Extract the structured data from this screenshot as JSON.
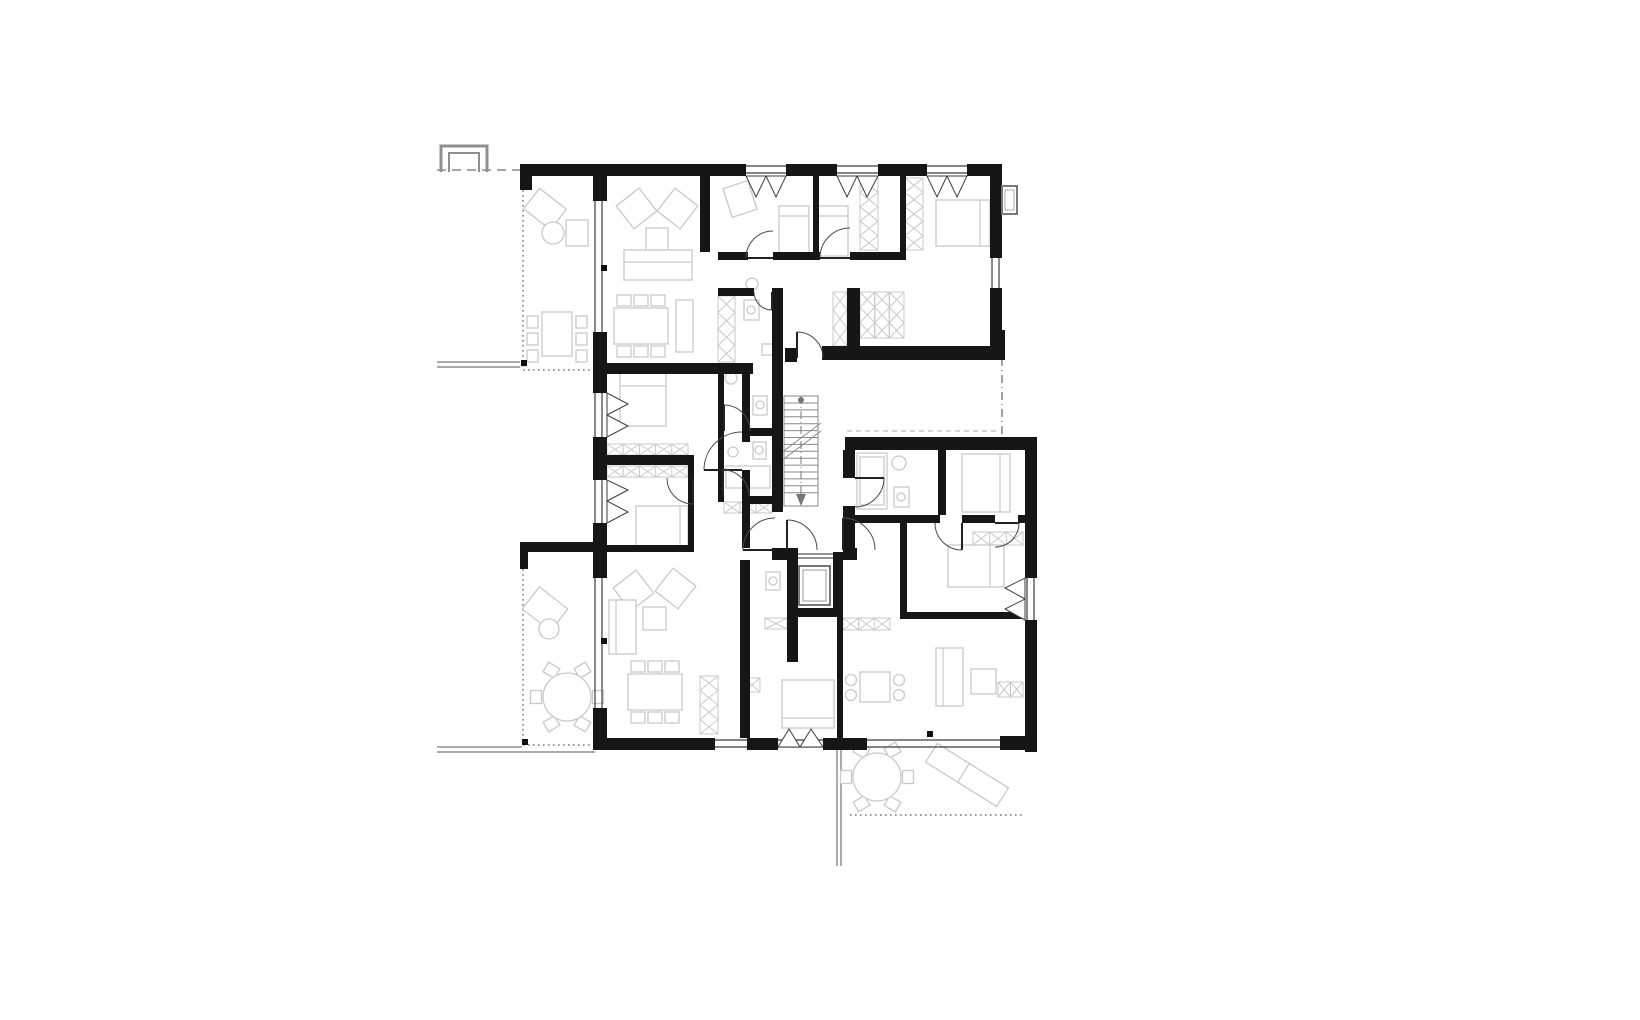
{
  "canvas": {
    "w": 1640,
    "h": 1020,
    "bg": "#ffffff"
  },
  "palette": {
    "wall": "#161616",
    "line": "#3c3c3c",
    "door": "#4a4a4a",
    "light": "#c9c9c9",
    "mid": "#8f8f8f",
    "stair": "#8a8a8a",
    "dot": "#111111",
    "bg": "#ffffff"
  },
  "plan": {
    "thin_lines": [
      [
        437,
        362,
        520,
        362
      ],
      [
        437,
        367,
        520,
        367
      ],
      [
        437,
        747,
        522,
        747
      ],
      [
        437,
        752,
        595,
        752
      ],
      [
        837,
        750,
        837,
        866
      ],
      [
        841,
        750,
        841,
        866
      ]
    ],
    "dashed_lines": [
      {
        "p": [
          437,
          170,
          520,
          170
        ],
        "d": "9 6",
        "c": "#8a8a8a"
      },
      {
        "p": [
          1002,
          358,
          1002,
          437
        ],
        "d": "8 4 1 4",
        "c": "#8a8a8a"
      },
      {
        "p": [
          847,
          431,
          1000,
          431
        ],
        "d": "5 4",
        "c": "#c9c9c9"
      }
    ],
    "dotted_edges": [
      [
        523,
        190,
        523,
        370
      ],
      [
        523,
        370,
        593,
        370
      ],
      [
        523,
        569,
        523,
        745
      ],
      [
        523,
        745,
        593,
        745
      ],
      [
        850,
        815,
        1025,
        815
      ]
    ],
    "chimney": [
      [
        [
          441,
          172
        ],
        [
          441,
          146
        ],
        [
          487,
          146
        ],
        [
          487,
          172
        ]
      ],
      [
        [
          449,
          172
        ],
        [
          449,
          153
        ],
        [
          479,
          153
        ],
        [
          479,
          172
        ]
      ]
    ],
    "walls": [
      [
        520,
        164,
        226,
        12
      ],
      [
        786,
        164,
        51,
        12
      ],
      [
        878,
        164,
        49,
        12
      ],
      [
        967,
        164,
        35,
        12
      ],
      [
        990,
        164,
        12,
        94
      ],
      [
        990,
        288,
        12,
        58
      ],
      [
        993,
        330,
        12,
        16
      ],
      [
        822,
        346,
        183,
        14
      ],
      [
        785,
        348,
        12,
        14
      ],
      [
        520,
        164,
        12,
        26
      ],
      [
        593,
        176,
        14,
        25
      ],
      [
        593,
        332,
        14,
        31
      ],
      [
        593,
        363,
        160,
        11
      ],
      [
        700,
        176,
        10,
        76
      ],
      [
        718,
        252,
        30,
        8
      ],
      [
        773,
        252,
        47,
        8
      ],
      [
        850,
        252,
        55,
        8
      ],
      [
        813,
        176,
        6,
        84
      ],
      [
        900,
        176,
        6,
        84
      ],
      [
        718,
        288,
        36,
        8
      ],
      [
        772,
        288,
        11,
        224
      ],
      [
        847,
        288,
        13,
        72
      ],
      [
        742,
        368,
        8,
        74
      ],
      [
        742,
        470,
        8,
        78
      ],
      [
        593,
        374,
        14,
        19
      ],
      [
        593,
        437,
        14,
        43
      ],
      [
        593,
        523,
        14,
        55
      ],
      [
        593,
        708,
        14,
        42
      ],
      [
        520,
        542,
        87,
        10
      ],
      [
        520,
        542,
        8,
        27
      ],
      [
        607,
        455,
        86,
        10
      ],
      [
        688,
        455,
        6,
        95
      ],
      [
        607,
        545,
        87,
        7
      ],
      [
        718,
        368,
        6,
        134
      ],
      [
        750,
        428,
        22,
        8
      ],
      [
        749,
        496,
        23,
        8
      ],
      [
        740,
        560,
        10,
        178
      ],
      [
        772,
        548,
        16,
        12
      ],
      [
        843,
        548,
        14,
        12
      ],
      [
        787,
        548,
        11,
        69
      ],
      [
        833,
        552,
        10,
        64
      ],
      [
        787,
        608,
        56,
        9
      ],
      [
        787,
        617,
        11,
        45
      ],
      [
        837,
        617,
        6,
        121
      ],
      [
        600,
        738,
        115,
        12
      ],
      [
        747,
        738,
        31,
        12
      ],
      [
        823,
        738,
        44,
        12
      ],
      [
        1000,
        736,
        37,
        14
      ],
      [
        845,
        437,
        192,
        13
      ],
      [
        1025,
        450,
        12,
        128
      ],
      [
        1025,
        620,
        12,
        132
      ],
      [
        843,
        450,
        12,
        28
      ],
      [
        843,
        506,
        12,
        42
      ],
      [
        855,
        515,
        85,
        8
      ],
      [
        962,
        515,
        33,
        8
      ],
      [
        1018,
        515,
        7,
        8
      ],
      [
        938,
        450,
        8,
        65
      ],
      [
        900,
        523,
        7,
        90
      ],
      [
        900,
        612,
        125,
        7
      ]
    ],
    "glazings": [
      {
        "o": "h",
        "x": 746,
        "y": 166,
        "l": 40
      },
      {
        "o": "h",
        "x": 837,
        "y": 166,
        "l": 41
      },
      {
        "o": "h",
        "x": 927,
        "y": 166,
        "l": 40
      },
      {
        "o": "v",
        "x": 992,
        "y": 258,
        "l": 30
      },
      {
        "o": "v",
        "x": 595,
        "y": 201,
        "l": 131
      },
      {
        "o": "v",
        "x": 595,
        "y": 393,
        "l": 44
      },
      {
        "o": "v",
        "x": 595,
        "y": 480,
        "l": 43
      },
      {
        "o": "v",
        "x": 595,
        "y": 578,
        "l": 130
      },
      {
        "o": "h",
        "x": 715,
        "y": 740,
        "l": 32
      },
      {
        "o": "h",
        "x": 778,
        "y": 740,
        "l": 45
      },
      {
        "o": "h",
        "x": 867,
        "y": 740,
        "l": 133
      },
      {
        "o": "v",
        "x": 1027,
        "y": 578,
        "l": 42
      }
    ],
    "triangles": [
      [
        746,
        176,
        766,
        176,
        756,
        197
      ],
      [
        766,
        176,
        786,
        176,
        776,
        197
      ],
      [
        837,
        176,
        857,
        176,
        847,
        197
      ],
      [
        857,
        176,
        878,
        176,
        867,
        197
      ],
      [
        927,
        176,
        947,
        176,
        937,
        197
      ],
      [
        947,
        176,
        967,
        176,
        957,
        197
      ],
      [
        607,
        393,
        607,
        415,
        628,
        404
      ],
      [
        607,
        415,
        607,
        437,
        628,
        426
      ],
      [
        607,
        480,
        607,
        501,
        628,
        490
      ],
      [
        607,
        501,
        607,
        523,
        628,
        512
      ],
      [
        778,
        747,
        800,
        747,
        789,
        729
      ],
      [
        800,
        747,
        823,
        747,
        811,
        729
      ],
      [
        1025,
        578,
        1025,
        599,
        1005,
        588
      ],
      [
        1025,
        599,
        1025,
        620,
        1005,
        609
      ]
    ],
    "xstrips": [
      [
        718,
        296,
        17,
        66
      ],
      [
        860,
        178,
        18,
        72
      ],
      [
        905,
        178,
        18,
        72
      ],
      [
        860,
        292,
        44,
        46
      ],
      [
        833,
        292,
        14,
        54
      ],
      [
        607,
        444,
        81,
        11
      ],
      [
        607,
        466,
        81,
        11
      ],
      [
        724,
        502,
        48,
        11
      ],
      [
        765,
        618,
        22,
        11
      ],
      [
        843,
        618,
        47,
        12
      ],
      [
        973,
        532,
        50,
        13
      ],
      [
        700,
        676,
        18,
        58
      ],
      [
        744,
        678,
        16,
        14
      ],
      [
        998,
        682,
        25,
        15
      ]
    ],
    "furn_rects": [
      [
        528,
        196,
        34,
        26,
        38
      ],
      [
        566,
        220,
        22,
        26,
        0
      ],
      [
        542,
        312,
        30,
        44,
        0
      ],
      [
        527,
        316,
        11,
        12,
        0
      ],
      [
        527,
        333,
        11,
        12,
        0
      ],
      [
        527,
        350,
        11,
        12,
        0
      ],
      [
        576,
        316,
        11,
        12,
        0
      ],
      [
        576,
        333,
        11,
        12,
        0
      ],
      [
        576,
        350,
        11,
        12,
        0
      ],
      [
        622,
        194,
        29,
        29,
        -38
      ],
      [
        663,
        194,
        29,
        29,
        38
      ],
      [
        646,
        228,
        22,
        22,
        0
      ],
      [
        624,
        250,
        68,
        30,
        0
      ],
      [
        614,
        308,
        54,
        36,
        0
      ],
      [
        617,
        295,
        14,
        11,
        0
      ],
      [
        634,
        295,
        14,
        11,
        0
      ],
      [
        651,
        295,
        14,
        11,
        0
      ],
      [
        617,
        346,
        14,
        11,
        0
      ],
      [
        634,
        346,
        14,
        11,
        0
      ],
      [
        651,
        346,
        14,
        11,
        0
      ],
      [
        676,
        300,
        17,
        52,
        0
      ],
      [
        727,
        184,
        26,
        30,
        -18
      ],
      [
        779,
        206,
        30,
        50,
        0
      ],
      [
        816,
        206,
        32,
        50,
        0
      ],
      [
        936,
        200,
        54,
        46,
        0
      ],
      [
        744,
        300,
        15,
        20,
        0
      ],
      [
        762,
        344,
        11,
        11,
        0
      ],
      [
        620,
        372,
        46,
        54,
        0
      ],
      [
        636,
        506,
        52,
        40,
        0
      ],
      [
        753,
        396,
        14,
        19,
        0
      ],
      [
        726,
        466,
        44,
        22,
        0
      ],
      [
        753,
        442,
        13,
        17,
        0
      ],
      [
        619,
        576,
        29,
        29,
        -38
      ],
      [
        661,
        574,
        29,
        29,
        38
      ],
      [
        643,
        607,
        23,
        23,
        0
      ],
      [
        609,
        600,
        27,
        54,
        0
      ],
      [
        628,
        674,
        54,
        36,
        0
      ],
      [
        631,
        661,
        14,
        11,
        0
      ],
      [
        648,
        661,
        14,
        11,
        0
      ],
      [
        665,
        661,
        14,
        11,
        0
      ],
      [
        631,
        712,
        14,
        11,
        0
      ],
      [
        648,
        712,
        14,
        11,
        0
      ],
      [
        665,
        712,
        14,
        11,
        0
      ],
      [
        766,
        572,
        14,
        18,
        0
      ],
      [
        782,
        680,
        52,
        48,
        0
      ],
      [
        527,
        595,
        36,
        28,
        38
      ],
      [
        591.5,
        691.5,
        13,
        11,
        90
      ],
      [
        576,
        664.7,
        13,
        11,
        150
      ],
      [
        545,
        664.7,
        13,
        11,
        210
      ],
      [
        529.5,
        691.5,
        13,
        11,
        270
      ],
      [
        545,
        718.3,
        13,
        11,
        330
      ],
      [
        576,
        718.3,
        13,
        11,
        30
      ],
      [
        857,
        453,
        30,
        56,
        0
      ],
      [
        860,
        457,
        24,
        48,
        0
      ],
      [
        894,
        487,
        15,
        20,
        0
      ],
      [
        962,
        454,
        48,
        58,
        0
      ],
      [
        948,
        545,
        56,
        42,
        0
      ],
      [
        860,
        672,
        30,
        30,
        0
      ],
      [
        936,
        648,
        27,
        58,
        0
      ],
      [
        971,
        669,
        25,
        25,
        0
      ],
      [
        901.5,
        771.5,
        13,
        11,
        90
      ],
      [
        886,
        744.7,
        13,
        11,
        150
      ],
      [
        855,
        744.7,
        13,
        11,
        210
      ],
      [
        839.5,
        771.5,
        13,
        11,
        270
      ],
      [
        855,
        798.3,
        13,
        11,
        330
      ],
      [
        886,
        798.3,
        13,
        11,
        30
      ],
      [
        928,
        754,
        46,
        22,
        32
      ],
      [
        960,
        774,
        46,
        22,
        32
      ]
    ],
    "furn_circles": [
      [
        553,
        233,
        11
      ],
      [
        549,
        629,
        10
      ],
      [
        567,
        697,
        24
      ],
      [
        877,
        777,
        24
      ],
      [
        752,
        284,
        6
      ],
      [
        751,
        310,
        4
      ],
      [
        731,
        378,
        6
      ],
      [
        760,
        405,
        4
      ],
      [
        759,
        450,
        4
      ],
      [
        733,
        452,
        5
      ],
      [
        773,
        581,
        4
      ],
      [
        899,
        463,
        7
      ],
      [
        901,
        497,
        4
      ],
      [
        851,
        680,
        5.5
      ],
      [
        851,
        695,
        5.5
      ],
      [
        899,
        680,
        5.5
      ],
      [
        899,
        695,
        5.5
      ]
    ],
    "furn_lines": [
      [
        779,
        216,
        809,
        216
      ],
      [
        816,
        216,
        848,
        216
      ],
      [
        980,
        200,
        980,
        246
      ],
      [
        620,
        386,
        666,
        386
      ],
      [
        680,
        506,
        680,
        546
      ],
      [
        1000,
        454,
        1000,
        512
      ],
      [
        990,
        545,
        990,
        587
      ],
      [
        782,
        718,
        834,
        718
      ],
      [
        624,
        262,
        692,
        262
      ],
      [
        616,
        600,
        616,
        654
      ],
      [
        943,
        648,
        943,
        706
      ]
    ],
    "arcs": [
      [
        773,
        258,
        27,
        180,
        270
      ],
      [
        850,
        258,
        30,
        180,
        270
      ],
      [
        772,
        292,
        18,
        90,
        180
      ],
      [
        797,
        358,
        26,
        270,
        360
      ],
      [
        742,
        470,
        38,
        180,
        270
      ],
      [
        724,
        431,
        26,
        270,
        360
      ],
      [
        693,
        478,
        26,
        90,
        180
      ],
      [
        723,
        496,
        26,
        270,
        360
      ],
      [
        775,
        550,
        32,
        180,
        270
      ],
      [
        787,
        550,
        30,
        270,
        360
      ],
      [
        843,
        550,
        32,
        270,
        360
      ],
      [
        855,
        478,
        29,
        0,
        90
      ],
      [
        962,
        523,
        27,
        90,
        180
      ],
      [
        995,
        523,
        24,
        0,
        90
      ]
    ],
    "stairs": {
      "frame": [
        784,
        396,
        34,
        110
      ],
      "tread_x": [
        784,
        818
      ],
      "tread_y0": 403,
      "tread_step": 6.9,
      "tread_n": 14,
      "rail_x": 801,
      "rail_y": [
        396,
        500
      ],
      "arrow": [
        801,
        506,
        5,
        12
      ],
      "dot": [
        801,
        400,
        3
      ],
      "breaks": [
        [
          781,
          461,
          821,
          431
        ],
        [
          781,
          453,
          821,
          423
        ]
      ]
    },
    "elevator": {
      "outer": [
        799,
        566,
        31,
        39
      ],
      "inner": [
        803,
        570,
        23,
        31
      ],
      "doors": [
        [
          798,
          554,
          833,
          554
        ],
        [
          798,
          558,
          833,
          558
        ]
      ]
    },
    "dots": [
      [
        521,
        360
      ],
      [
        522,
        739
      ],
      [
        601,
        265
      ],
      [
        601,
        638
      ],
      [
        927,
        731
      ]
    ],
    "vent": {
      "rect": [
        1002,
        186,
        15,
        28
      ],
      "inner": [
        1005,
        190,
        9,
        20
      ]
    }
  }
}
